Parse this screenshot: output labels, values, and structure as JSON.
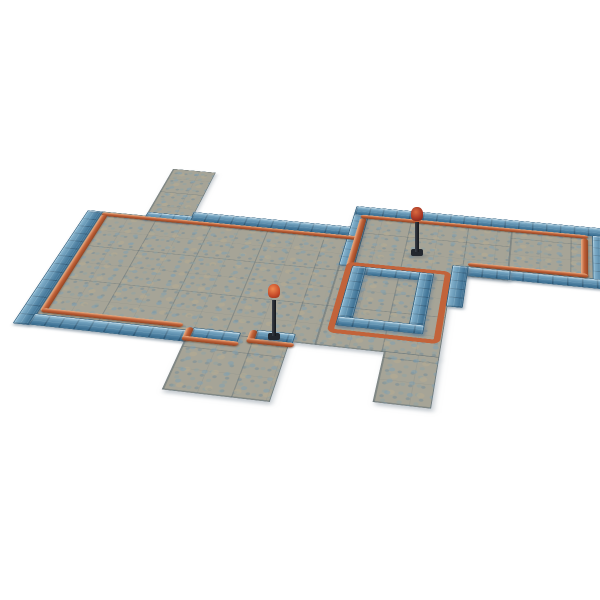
{
  "scene": {
    "description": "Product photo of a modular tabletop dungeon floor tile set viewed at an angle on a plain white background: interlocking grey cobblestone floor sections bordered by raised blue stone-brick wall strips, with copper-orange pipes running along the wall bases and around a central rectangular enclosure, plus two small torch lamp posts standing on the tiles.",
    "background_color": "#ffffff",
    "floor": {
      "label": "cobblestone floor sections",
      "count": 7,
      "base_color": "#a6a497",
      "stone_fleck_colors": [
        "#7d9fb3",
        "#b6ab92",
        "#8ba2a6"
      ]
    },
    "walls": {
      "label": "raised blue wall strips",
      "count": 17,
      "base_color": "#4c8cb3",
      "edge_color": "#2c5d7e",
      "highlight_color": "#bde2f2"
    },
    "pipes": {
      "label": "copper pipe trim",
      "count": 12,
      "color": "#c2633a",
      "highlight_color": "#e8995f"
    },
    "lamps": [
      {
        "label": "torch lamp post (center floor)",
        "pole_color": "#23272e",
        "flame_color": "#e0612f"
      },
      {
        "label": "torch lamp post (right section)",
        "pole_color": "#23272e",
        "flame_color": "#b03a24"
      }
    ]
  }
}
